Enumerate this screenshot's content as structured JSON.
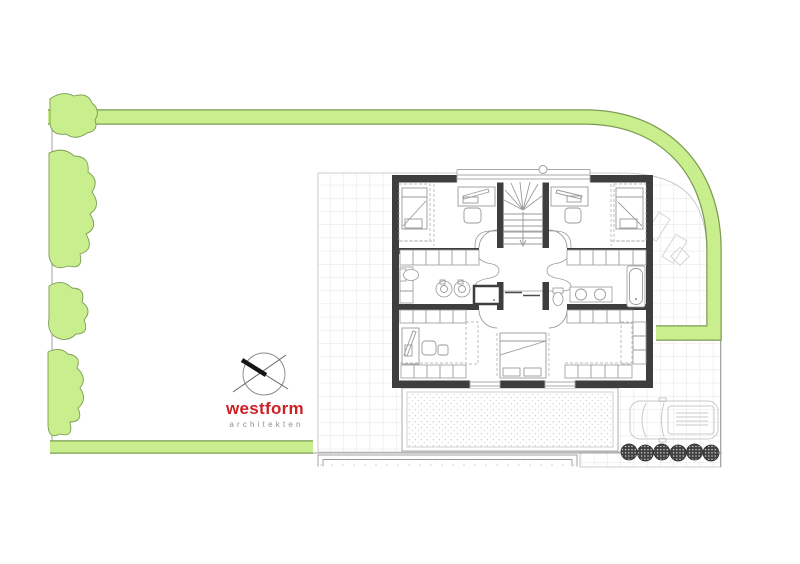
{
  "logo": {
    "brand": "westform",
    "tagline": "architekten"
  },
  "palette": {
    "hedge_green": "#c8ee8e",
    "hedge_edge": "#7d9c52",
    "wall_dark": "#3e3e3e",
    "brand_red": "#cc2127",
    "tagline_gray": "#8f8f8f",
    "line_gray": "#9a9a9a",
    "grid_line": "#e4e4e4",
    "faint_line": "#d2d2d2"
  },
  "site": {
    "shrub_count": 6,
    "tree_count": 4
  }
}
